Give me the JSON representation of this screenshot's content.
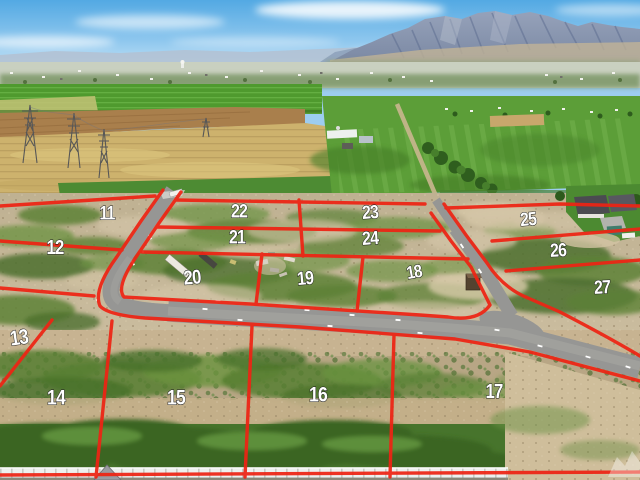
{
  "overlay": {
    "line_color": "#ee2414",
    "label_color": "#ffffff",
    "label_outline_color": "#1e1e1e",
    "lots": [
      {
        "number": "11",
        "x": 107,
        "y": 213,
        "fs": 19,
        "rot": 0
      },
      {
        "number": "12",
        "x": 55,
        "y": 247,
        "fs": 20,
        "rot": 0
      },
      {
        "number": "13",
        "x": 19,
        "y": 338,
        "fs": 21,
        "rot": -8
      },
      {
        "number": "14",
        "x": 56,
        "y": 398,
        "fs": 21,
        "rot": 0
      },
      {
        "number": "15",
        "x": 176,
        "y": 398,
        "fs": 21,
        "rot": 0
      },
      {
        "number": "16",
        "x": 318,
        "y": 395,
        "fs": 21,
        "rot": 0
      },
      {
        "number": "17",
        "x": 494,
        "y": 391,
        "fs": 20,
        "rot": 0
      },
      {
        "number": "18",
        "x": 414,
        "y": 272,
        "fs": 18,
        "rot": -10
      },
      {
        "number": "19",
        "x": 305,
        "y": 278,
        "fs": 19,
        "rot": -5
      },
      {
        "number": "20",
        "x": 192,
        "y": 277,
        "fs": 20,
        "rot": -5
      },
      {
        "number": "21",
        "x": 237,
        "y": 237,
        "fs": 19,
        "rot": 0
      },
      {
        "number": "22",
        "x": 239,
        "y": 211,
        "fs": 19,
        "rot": 0
      },
      {
        "number": "23",
        "x": 370,
        "y": 212,
        "fs": 19,
        "rot": -4
      },
      {
        "number": "24",
        "x": 370,
        "y": 238,
        "fs": 19,
        "rot": -4
      },
      {
        "number": "25",
        "x": 528,
        "y": 219,
        "fs": 19,
        "rot": -5
      },
      {
        "number": "26",
        "x": 558,
        "y": 250,
        "fs": 19,
        "rot": -3
      },
      {
        "number": "27",
        "x": 602,
        "y": 287,
        "fs": 19,
        "rot": -3
      }
    ]
  }
}
